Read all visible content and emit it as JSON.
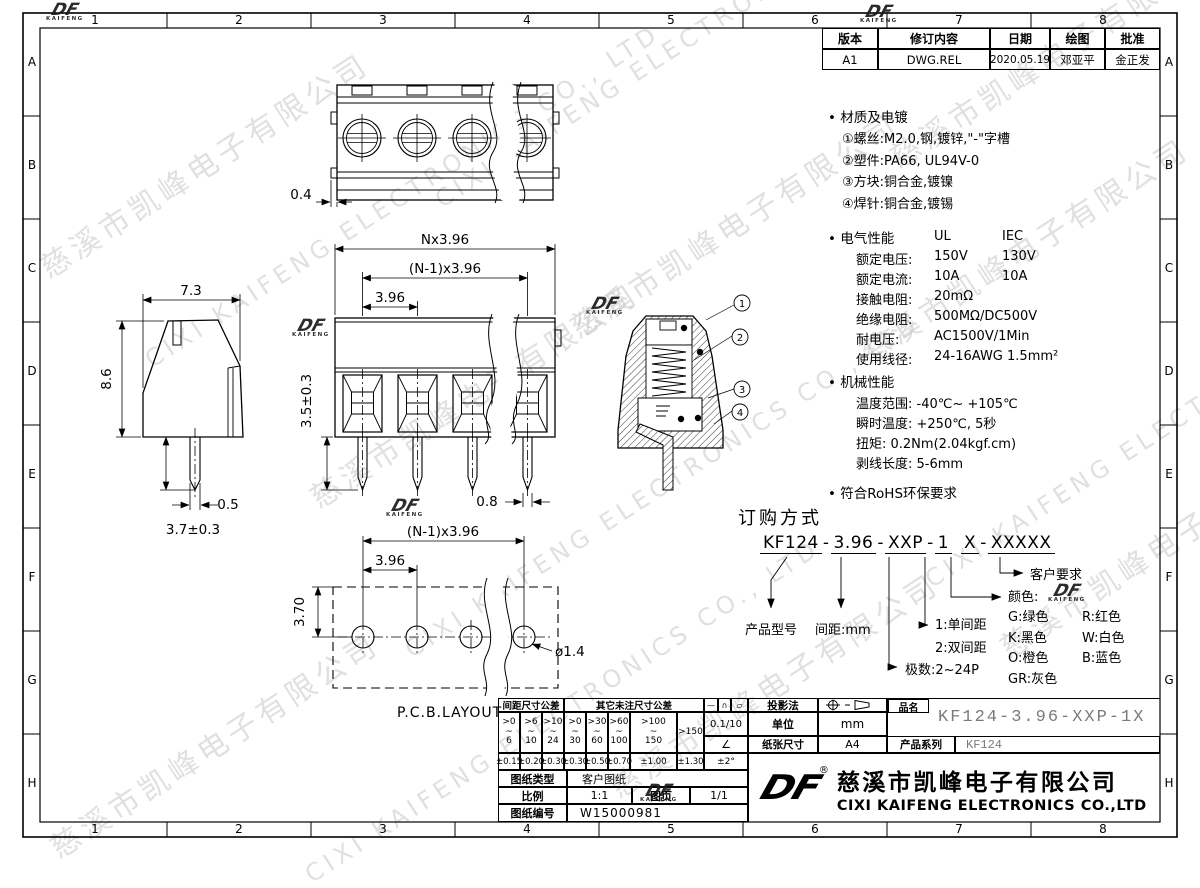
{
  "watermark": {
    "cn": "慈溪市凯峰电子有限公司",
    "en": "CIXI KAIFENG ELECTRONICS CO., LTD"
  },
  "logo": {
    "df": "DF",
    "sub": "KAIFENG",
    "reg": "®"
  },
  "border": {
    "cols": [
      "1",
      "2",
      "3",
      "4",
      "5",
      "6",
      "7",
      "8"
    ],
    "rows": [
      "A",
      "B",
      "C",
      "D",
      "E",
      "F",
      "G",
      "H"
    ]
  },
  "revision": {
    "headers": [
      "版本",
      "修订内容",
      "日期",
      "绘图",
      "批准"
    ],
    "row": [
      "A1",
      "DWG.REL",
      "2020.05.19",
      "邓亚平",
      "金正发"
    ]
  },
  "specs": {
    "material_title": "材质及电镀",
    "material_items": [
      "①螺丝:M2.0,钢,镀锌,\"-\"字槽",
      "②塑件:PA66, UL94V-0",
      "③方块:铜合金,镀镍",
      "④焊针:铜合金,镀锡"
    ],
    "elec_title": "电气性能",
    "elec_col1": "UL",
    "elec_col2": "IEC",
    "elec_rows": [
      {
        "l": "额定电压:",
        "ul": "150V",
        "iec": "130V"
      },
      {
        "l": "额定电流:",
        "ul": "10A",
        "iec": "10A"
      },
      {
        "l": "接触电阻:",
        "ul": "20mΩ",
        "iec": ""
      },
      {
        "l": "绝缘电阻:",
        "ul": "500MΩ/DC500V",
        "iec": ""
      },
      {
        "l": "耐电压:",
        "ul": "AC1500V/1Min",
        "iec": ""
      },
      {
        "l": "使用线径:",
        "ul": "24-16AWG 1.5mm²",
        "iec": ""
      }
    ],
    "mech_title": "机械性能",
    "mech_rows": [
      "温度范围: -40℃~ +105℃",
      "瞬时温度: +250℃, 5秒",
      "扭矩: 0.2Nm(2.04kgf.cm)",
      "剥线长度: 5-6mm"
    ],
    "rohs": "符合RoHS环保要求"
  },
  "ordering": {
    "title": "订购方式",
    "part": {
      "p1": "KF124",
      "p2": "3.96",
      "p3": "XXP",
      "p4": "1",
      "p5": "X",
      "p6": "XXXXX",
      "sep": "-"
    },
    "model_label": "产品型号",
    "pitch_label": "间距:mm",
    "poles_label": "极数:2~24P",
    "pitch_opt1": "1:单间距",
    "pitch_opt2": "2:双间距",
    "customer_label": "客户要求",
    "color_title": "颜色:",
    "colors": [
      {
        "a": "G:绿色",
        "b": "R:红色"
      },
      {
        "a": "K:黑色",
        "b": "W:白色"
      },
      {
        "a": "O:橙色",
        "b": "B:蓝色"
      },
      {
        "a": "GR:灰色",
        "b": ""
      }
    ]
  },
  "dims": {
    "top_offset": "0.4",
    "side_w": "7.3",
    "side_h": "8.6",
    "side_pin_w": "0.5",
    "side_pin_len": "3.7±0.3",
    "front_total": "Nx3.96",
    "front_span": "(N-1)x3.96",
    "front_pitch": "3.96",
    "front_pin_len": "3.5±0.3",
    "front_pin_w": "0.8",
    "pcb_span": "(N-1)x3.96",
    "pcb_pitch": "3.96",
    "pcb_row": "3.70",
    "pcb_hole": "ø1.4",
    "pcb_caption": "P.C.B.LAYOUT",
    "callouts": [
      "1",
      "2",
      "3",
      "4"
    ]
  },
  "titleblock": {
    "tol": {
      "pitch_header": "间距尺寸公差",
      "other_header": "其它未注尺寸公差",
      "sym1": "—",
      "sym2": "∩",
      "sym3": "▱",
      "flat": "0.1/10",
      "angle_sym": "∠",
      "angle_tol": "±2°",
      "ranges": [
        ">0\n~\n6",
        ">6\n~\n10",
        ">10\n~\n24",
        ">0\n~\n30",
        ">30\n~\n60",
        ">60\n~\n100",
        ">100\n~\n150",
        ">150"
      ],
      "tols": [
        "±0.15",
        "±0.20",
        "±0.30",
        "±0.30",
        "±0.50",
        "±0.70",
        "±1.00",
        "±1.30"
      ]
    },
    "type_label": "图纸类型",
    "type_value": "客户图纸",
    "scale_label": "比例",
    "scale_value": "1:1",
    "page_label": "图页",
    "page_value": "1/1",
    "no_label": "图纸编号",
    "no_value": "W15000981",
    "projection_label": "投影法",
    "unit_label": "单位",
    "unit_value": "mm",
    "paper_label": "纸张尺寸",
    "paper_value": "A4",
    "name_label": "品名",
    "name_value": "KF124-3.96-XXP-1X",
    "series_label": "产品系列",
    "series_value": "KF124",
    "company_cn": "慈溪市凯峰电子有限公司",
    "company_en": "CIXI KAIFENG ELECTRONICS CO.,LTD"
  }
}
